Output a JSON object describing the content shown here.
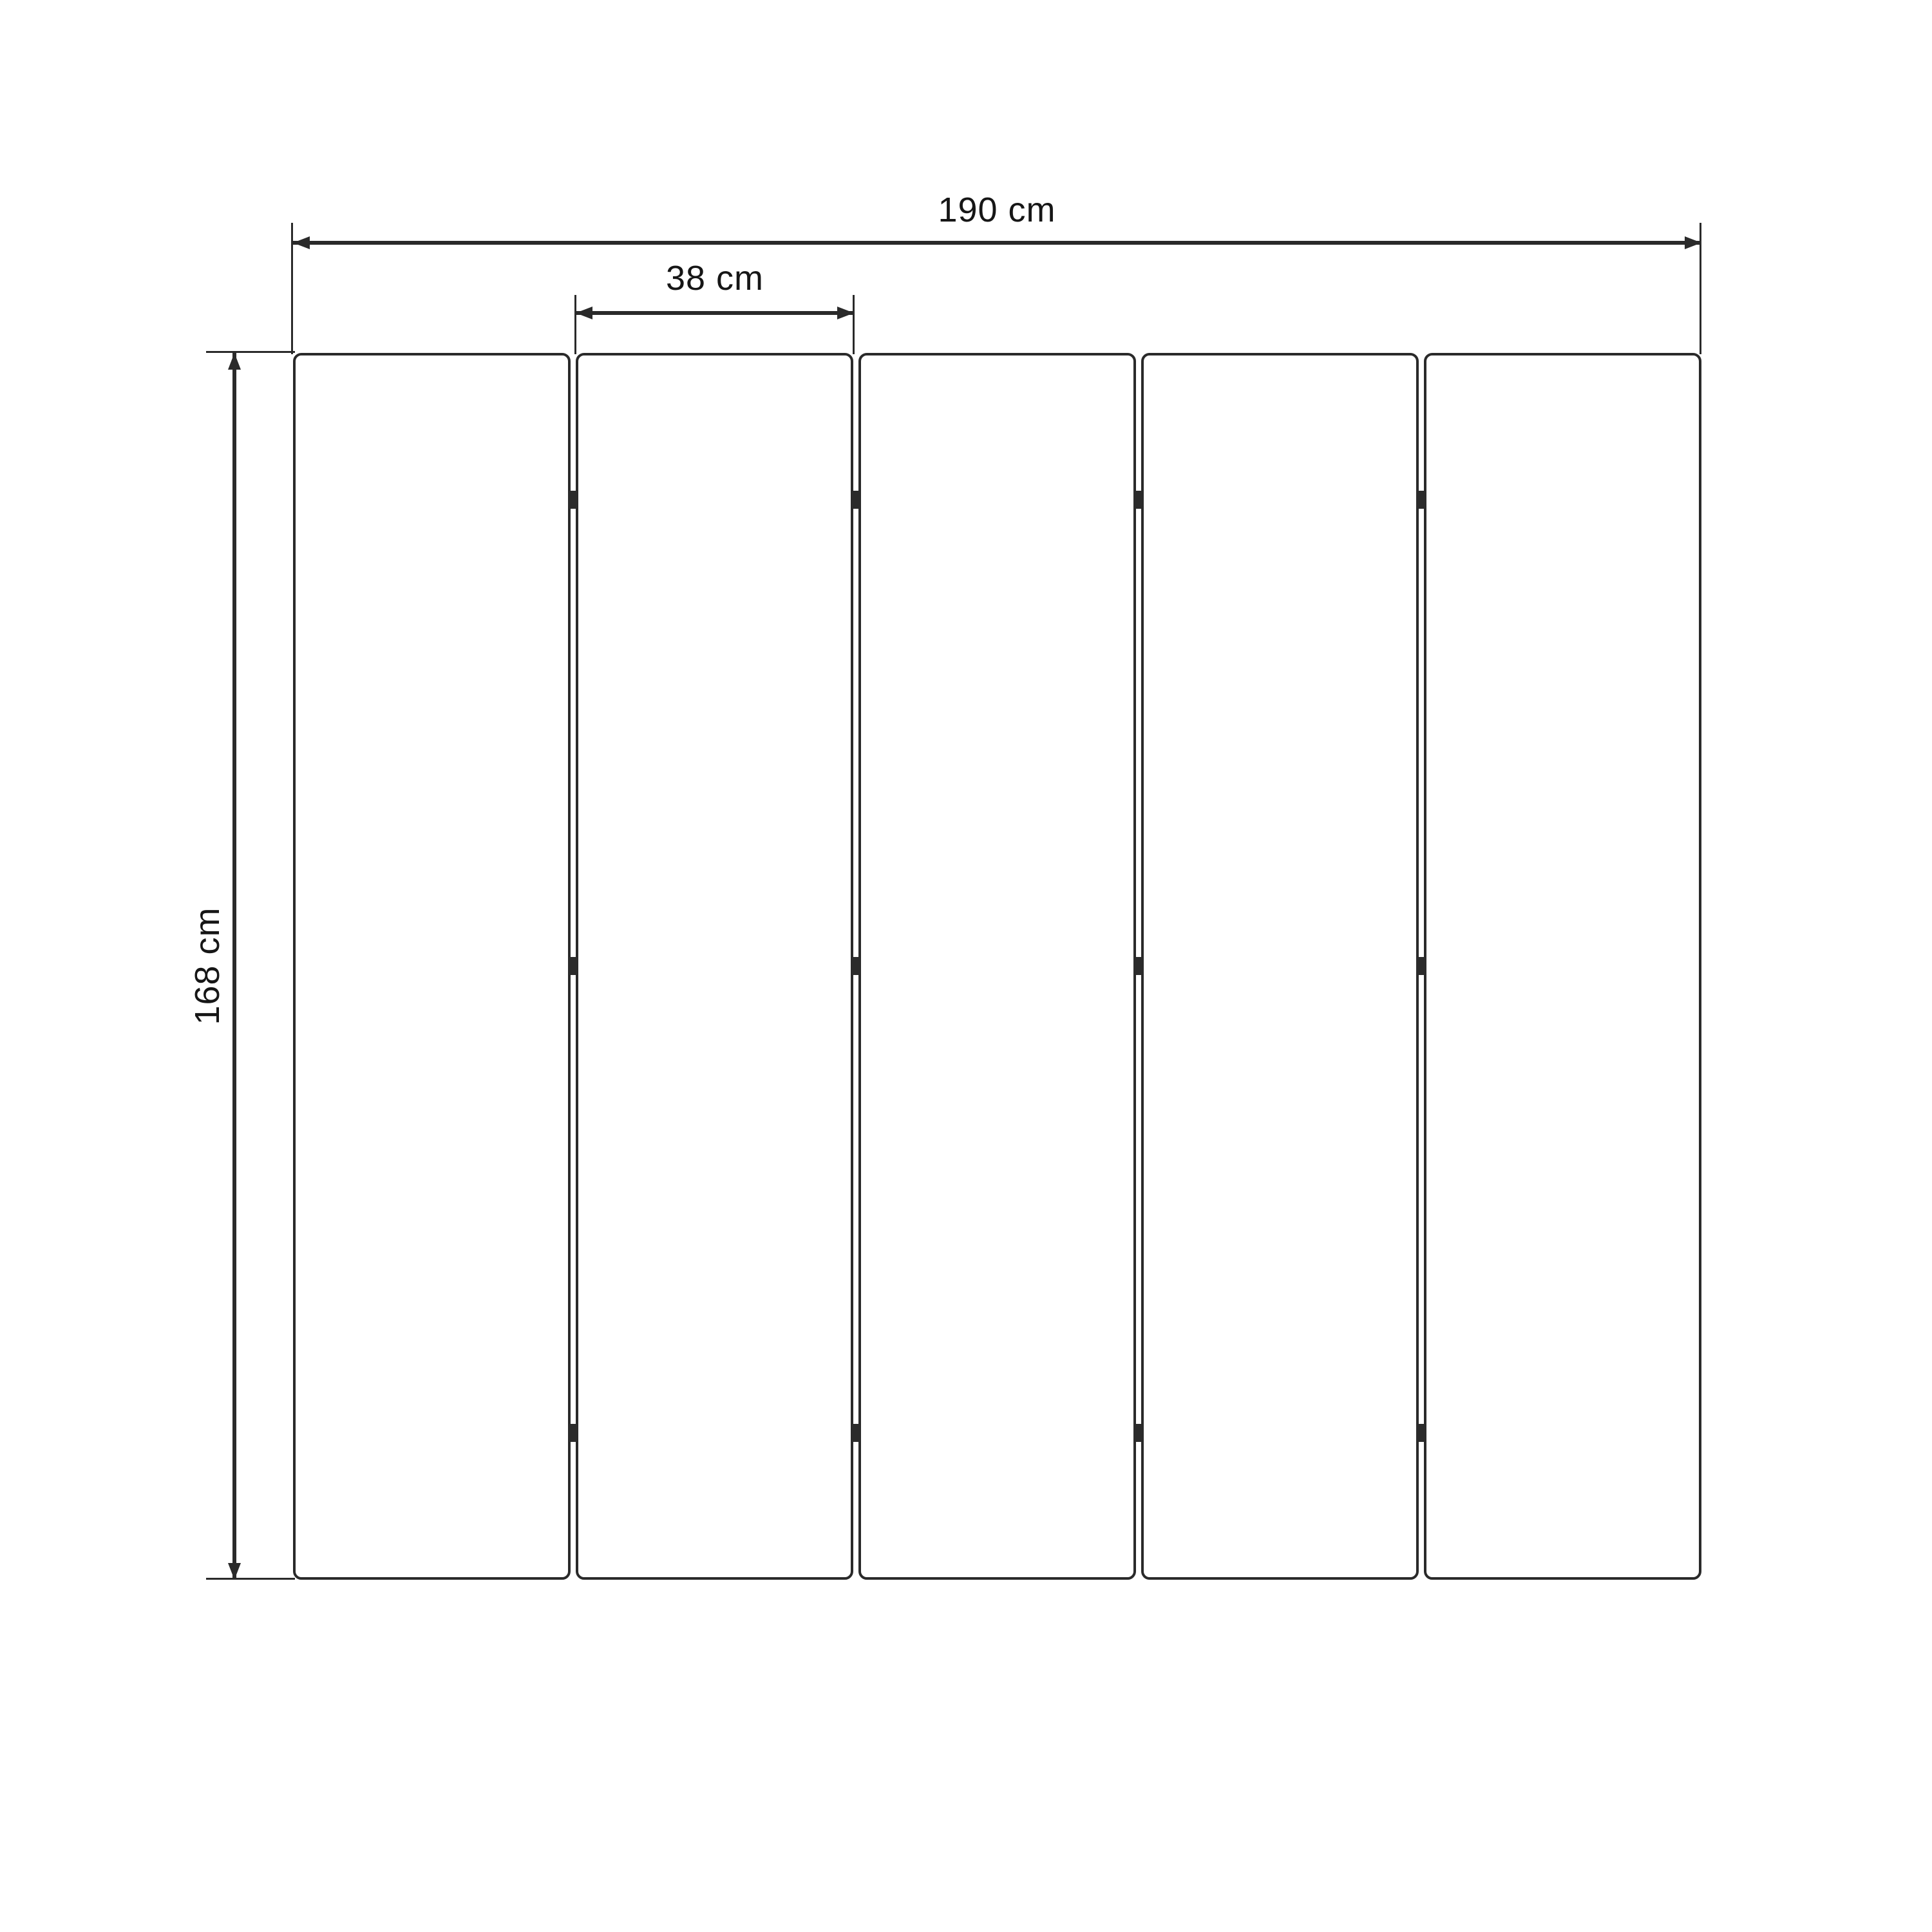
{
  "diagram": {
    "description": "Dimension drawing of a five-panel folding screen, front view",
    "background_color": "#ffffff",
    "line_color": "#2a2a2a",
    "hinge_color": "#2b2b2b",
    "text_color": "#161616",
    "panels": {
      "count": 5,
      "gaps": 4,
      "hinges_per_gap": 3
    },
    "dimensions": {
      "total_width": {
        "label": "190 cm",
        "value": 190,
        "unit": "cm"
      },
      "panel_width": {
        "label": "38 cm",
        "value": 38,
        "unit": "cm"
      },
      "height": {
        "label": "168 cm",
        "value": 168,
        "unit": "cm"
      }
    }
  }
}
